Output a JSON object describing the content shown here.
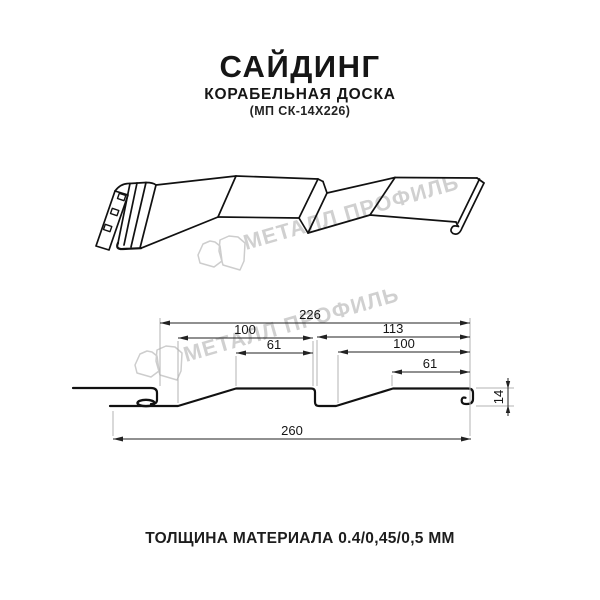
{
  "header": {
    "title": "САЙДИНГ",
    "subtitle": "КОРАБЕЛЬНАЯ ДОСКА",
    "model": "(МП СК-14Х226)"
  },
  "watermark": {
    "brand": "МЕТАЛЛ ПРОФИЛЬ"
  },
  "dimensions": {
    "overall_top": "226",
    "left_pitch": "100",
    "left_flat": "61",
    "right_total": "113",
    "right_pitch": "100",
    "right_flat": "61",
    "full_width": "260",
    "depth": "14"
  },
  "footer": {
    "thickness": "ТОЛЩИНА МАТЕРИАЛА 0.4/0,45/0,5 ММ"
  },
  "colors": {
    "line": "#111111",
    "dim_line": "#222222",
    "extension_line": "#b3b3b3",
    "watermark": "#d0d0d0"
  }
}
